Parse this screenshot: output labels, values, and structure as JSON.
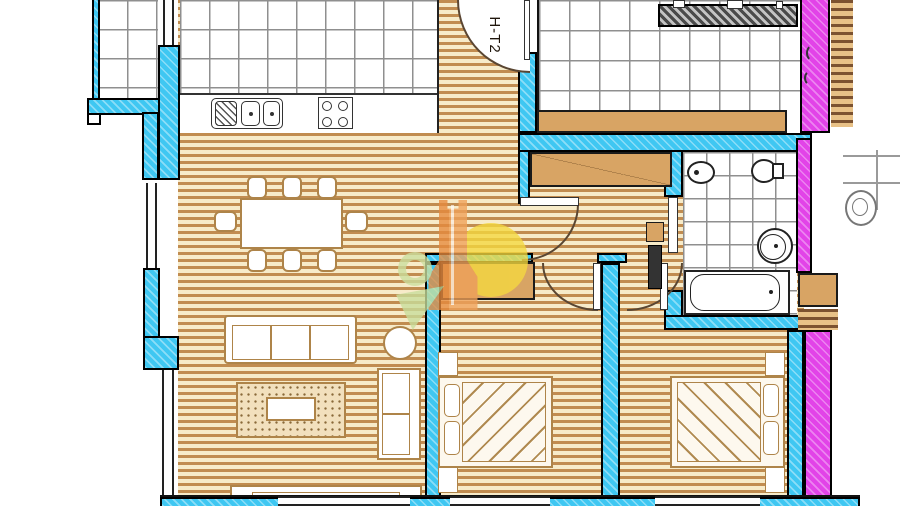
{
  "drawing": {
    "kind": "architectural floor plan",
    "unit_label": "H-T2"
  },
  "colors": {
    "exterior_wall": "#3fc7f2",
    "party_wall": "#e243e8",
    "neighbor_counter_wall": "#4a4a4a",
    "wood_floor_stripe": "#c18c50",
    "wood_floor_base": "#f7ebc9",
    "furniture_outline": "#ae8449",
    "wardrobe_fill": "#d8a464",
    "tile_line": "#8f8f8f",
    "watermark_tower": "#e78a3d",
    "watermark_sun": "#f5d93f",
    "watermark_leaf": "#c8de9c"
  },
  "fixtures": {
    "dining_chairs": 8,
    "dining_tables": 1,
    "sofas": 1,
    "armchairs": 1,
    "coffee_tables": 1,
    "side_tables": 1,
    "sideboards": 1,
    "rugs": 1,
    "beds": 2,
    "nightstands": 4,
    "wardrobes": 2,
    "kitchen_sink": 1,
    "stove_burners": 4,
    "bidet": 1,
    "toilet": 1,
    "washbasin": 1,
    "bathtub": 1
  }
}
